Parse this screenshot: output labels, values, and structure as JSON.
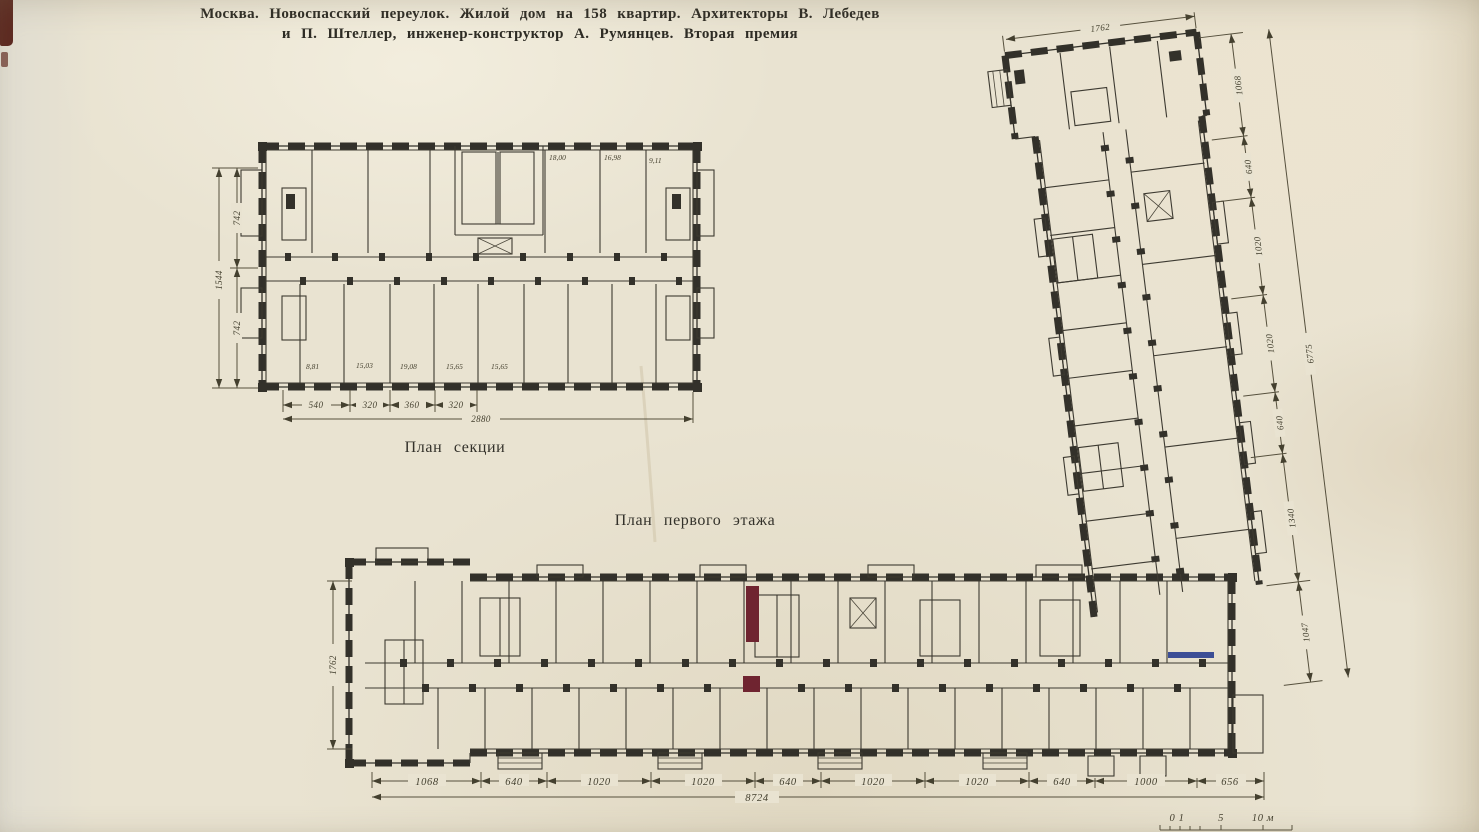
{
  "page": {
    "title_line1": "Москва. Новоспасский переулок. Жилой дом на 158 квартир. Архитекторы В. Лебедев",
    "title_line2": "и П. Штеллер, инженер-конструктор А. Румянцев. Вторая премия"
  },
  "section_plan": {
    "caption": "План секции",
    "room_areas_top": [
      "18,00",
      "16,98",
      "9,11"
    ],
    "room_areas_bottom": [
      "8,81",
      "15,03",
      "19,08",
      "15,65",
      "15,65"
    ],
    "width_dims": [
      "540",
      "320",
      "360",
      "320"
    ],
    "width_total": "2880",
    "left_dims": [
      "742",
      "742"
    ],
    "left_total": "1544"
  },
  "ground_floor": {
    "caption": "План первого этажа",
    "bottom_dims": [
      "1068",
      "640",
      "1020",
      "1020",
      "640",
      "1020",
      "1020",
      "640",
      "1000",
      "656"
    ],
    "bottom_total": "8724",
    "left_dim": "1762",
    "wing_top_dim": "1762",
    "wing_dims": [
      "1068",
      "640",
      "1020",
      "1020",
      "640",
      "1340",
      "1047"
    ],
    "wing_total": "6775"
  },
  "scale_bar": {
    "labels": [
      "0 1",
      "5",
      "10 м"
    ]
  },
  "colors": {
    "paper": "#e9e3d1",
    "ink": "#33312a",
    "dim_ink": "#56503d",
    "red_mark": "#6f2430",
    "blue_mark": "#3c4e96"
  }
}
